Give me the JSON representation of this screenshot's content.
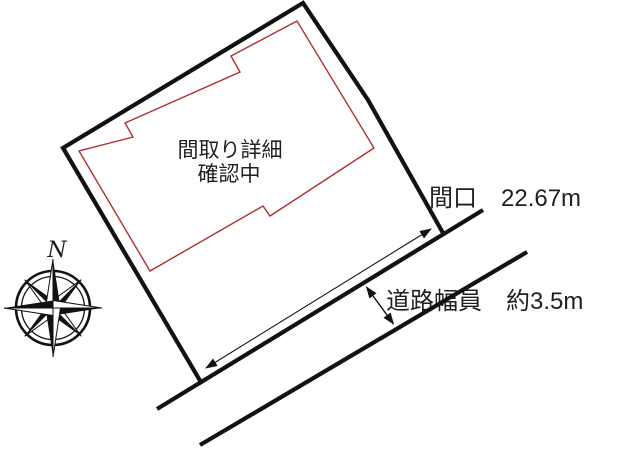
{
  "labels": {
    "floorplan_note_line1": "間取り詳細",
    "floorplan_note_line2": "確認中",
    "frontage": "間口　22.67m",
    "road_width": "道路幅員　約3.5m",
    "compass_north": "N"
  },
  "measurements": {
    "frontage": "22.67m",
    "road_width": "約3.5m"
  },
  "colors": {
    "ink": "#121212",
    "building_outline": "#b03030",
    "label_text": "#1f1f1f",
    "background": "#ffffff"
  }
}
